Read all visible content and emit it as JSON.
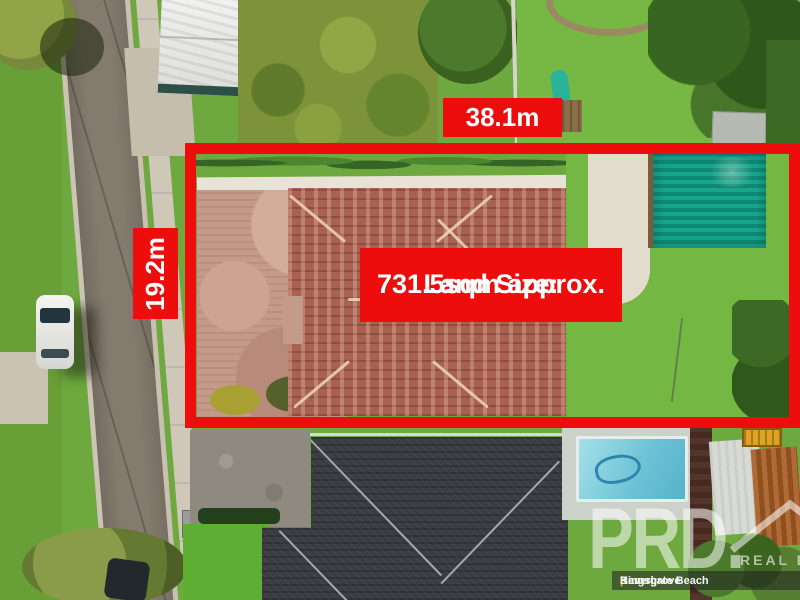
{
  "image_type": "aerial-real-estate-photo",
  "annotations": {
    "frontage_label": "38.1m",
    "depth_label": "19.2m",
    "land_size_line1": "Land Size:",
    "land_size_line2": "731.5sqm approx.",
    "boundary_color": "#ee0d0d",
    "label_text_color": "#ffffff"
  },
  "watermark": {
    "brand": "PRD.",
    "tagline": "REAL ES",
    "separator": "|",
    "offices": [
      "Ramsgate Beach",
      "Kingsgrove",
      "Beverl"
    ],
    "separator_color": "#eba73c"
  },
  "scene_colors": {
    "grass": "#6da93e",
    "road_asphalt": "#847b6e",
    "sidewalk_concrete": "#cfc8b8",
    "house_roof_terracotta": "#a86152",
    "brick_driveway": "#c49a8a",
    "shed_teal": "#17a58b",
    "neighbor_roof_charcoal": "#3a3d42",
    "pool_water": "#6ec3d6",
    "rust_roof": "#b06a38",
    "white_garage_roof": "#ebebe8"
  }
}
